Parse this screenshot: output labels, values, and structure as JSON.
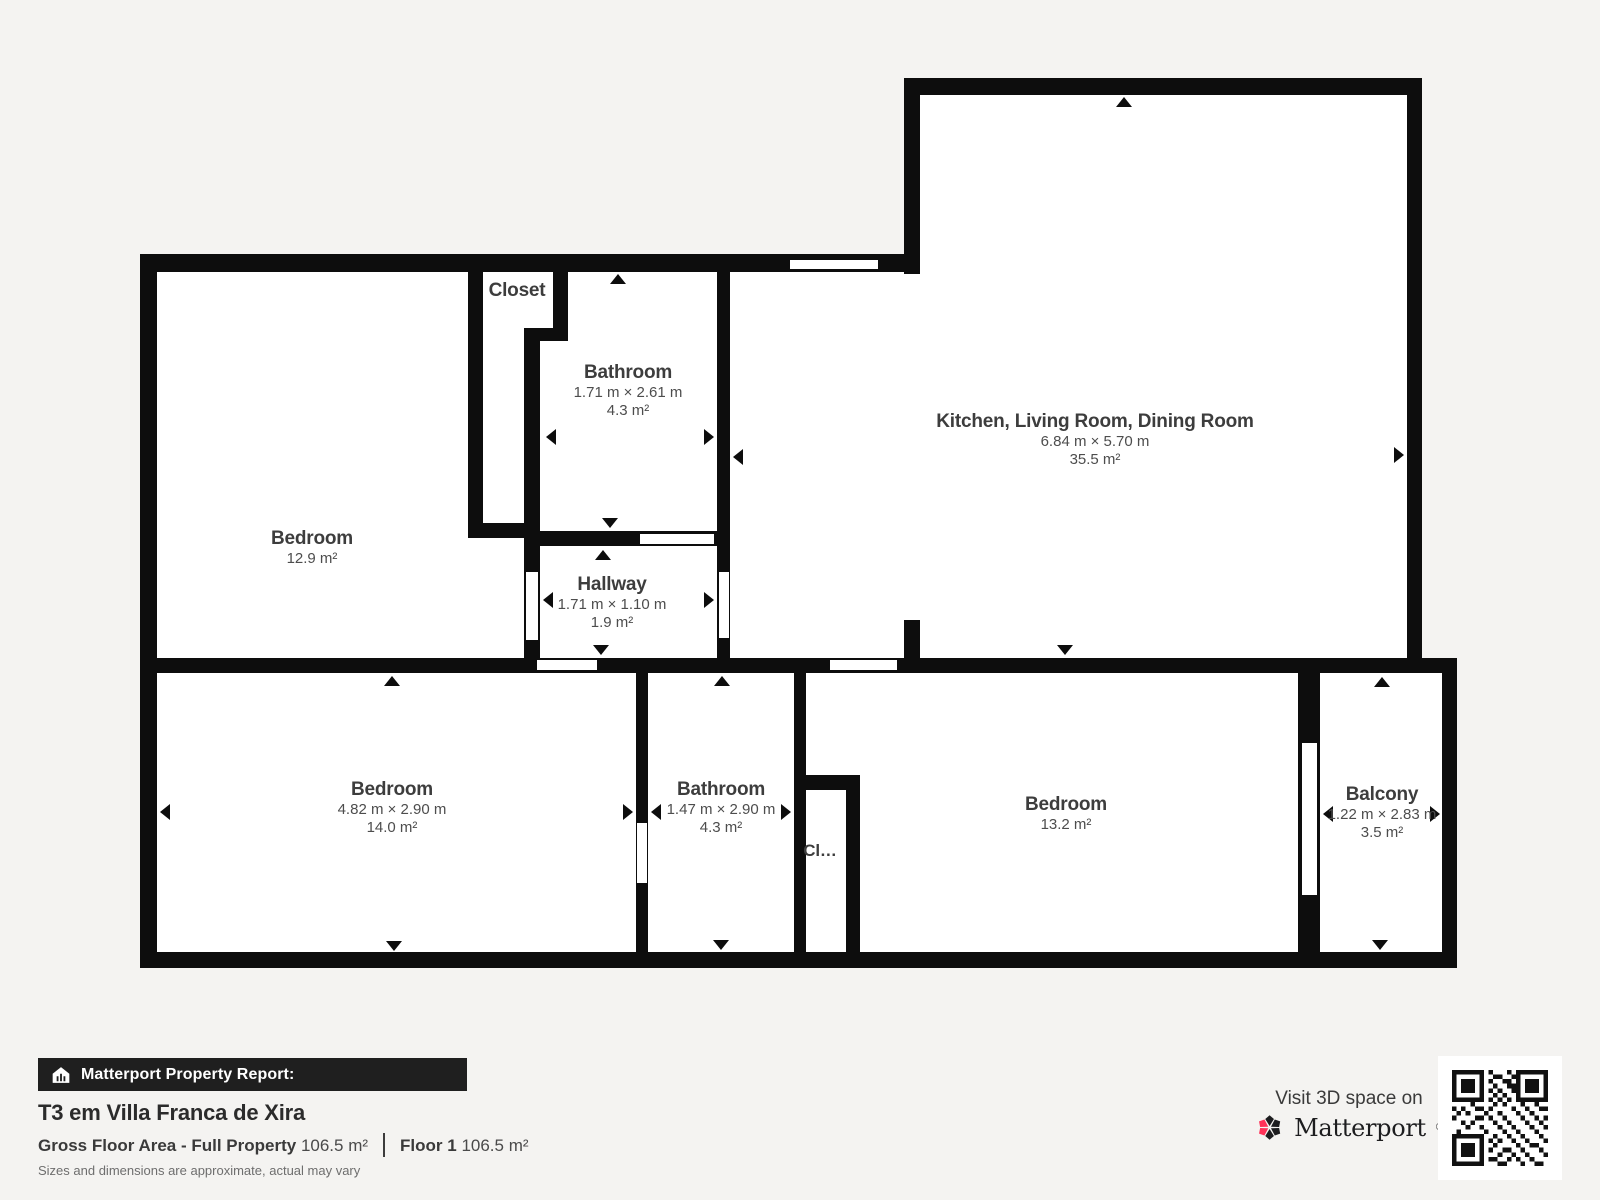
{
  "plan": {
    "rooms": {
      "bedroom_tl": {
        "name": "Bedroom",
        "area": "12.9 m²"
      },
      "closet_top": {
        "name": "Closet"
      },
      "bathroom_top": {
        "name": "Bathroom",
        "dims": "1.71 m × 2.61 m",
        "area": "4.3 m²"
      },
      "kitchen_living_dining": {
        "name": "Kitchen, Living Room, Dining Room",
        "dims": "6.84 m × 5.70 m",
        "area": "35.5 m²"
      },
      "hallway": {
        "name": "Hallway",
        "dims": "1.71 m × 1.10 m",
        "area": "1.9 m²"
      },
      "bedroom_bl": {
        "name": "Bedroom",
        "dims": "4.82 m × 2.90 m",
        "area": "14.0 m²"
      },
      "bathroom_bottom": {
        "name": "Bathroom",
        "dims": "1.47 m × 2.90 m",
        "area": "4.3 m²"
      },
      "closet_bottom": {
        "name": "Cl…"
      },
      "bedroom_br": {
        "name": "Bedroom",
        "area": "13.2 m²"
      },
      "balcony": {
        "name": "Balcony",
        "dims": "1.22 m × 2.83 m",
        "area": "3.5 m²"
      }
    }
  },
  "footer": {
    "report_label": "Matterport Property Report:",
    "property_title": "T3 em Villa Franca de Xira",
    "gross_area_label": "Gross Floor Area - Full Property",
    "gross_area_value": "106.5 m²",
    "floor_label": "Floor 1",
    "floor_value": "106.5 m²",
    "disclaimer": "Sizes and dimensions are approximate, actual may vary"
  },
  "branding": {
    "visit_text": "Visit 3D space on",
    "brand_name": "Matterport",
    "registered_mark": "®"
  },
  "icons": {
    "report_bar_icon": "matterport-house-icon",
    "brand_icon": "matterport-pinwheel-icon",
    "qr_icon": "qr-code"
  },
  "colors": {
    "background": "#f4f3f1",
    "wall": "#0d0d0d",
    "room_fill": "#ffffff",
    "bar_background": "#1f1f1f",
    "accent_pink": "#ff3158",
    "label_text": "#3d3d3d"
  }
}
